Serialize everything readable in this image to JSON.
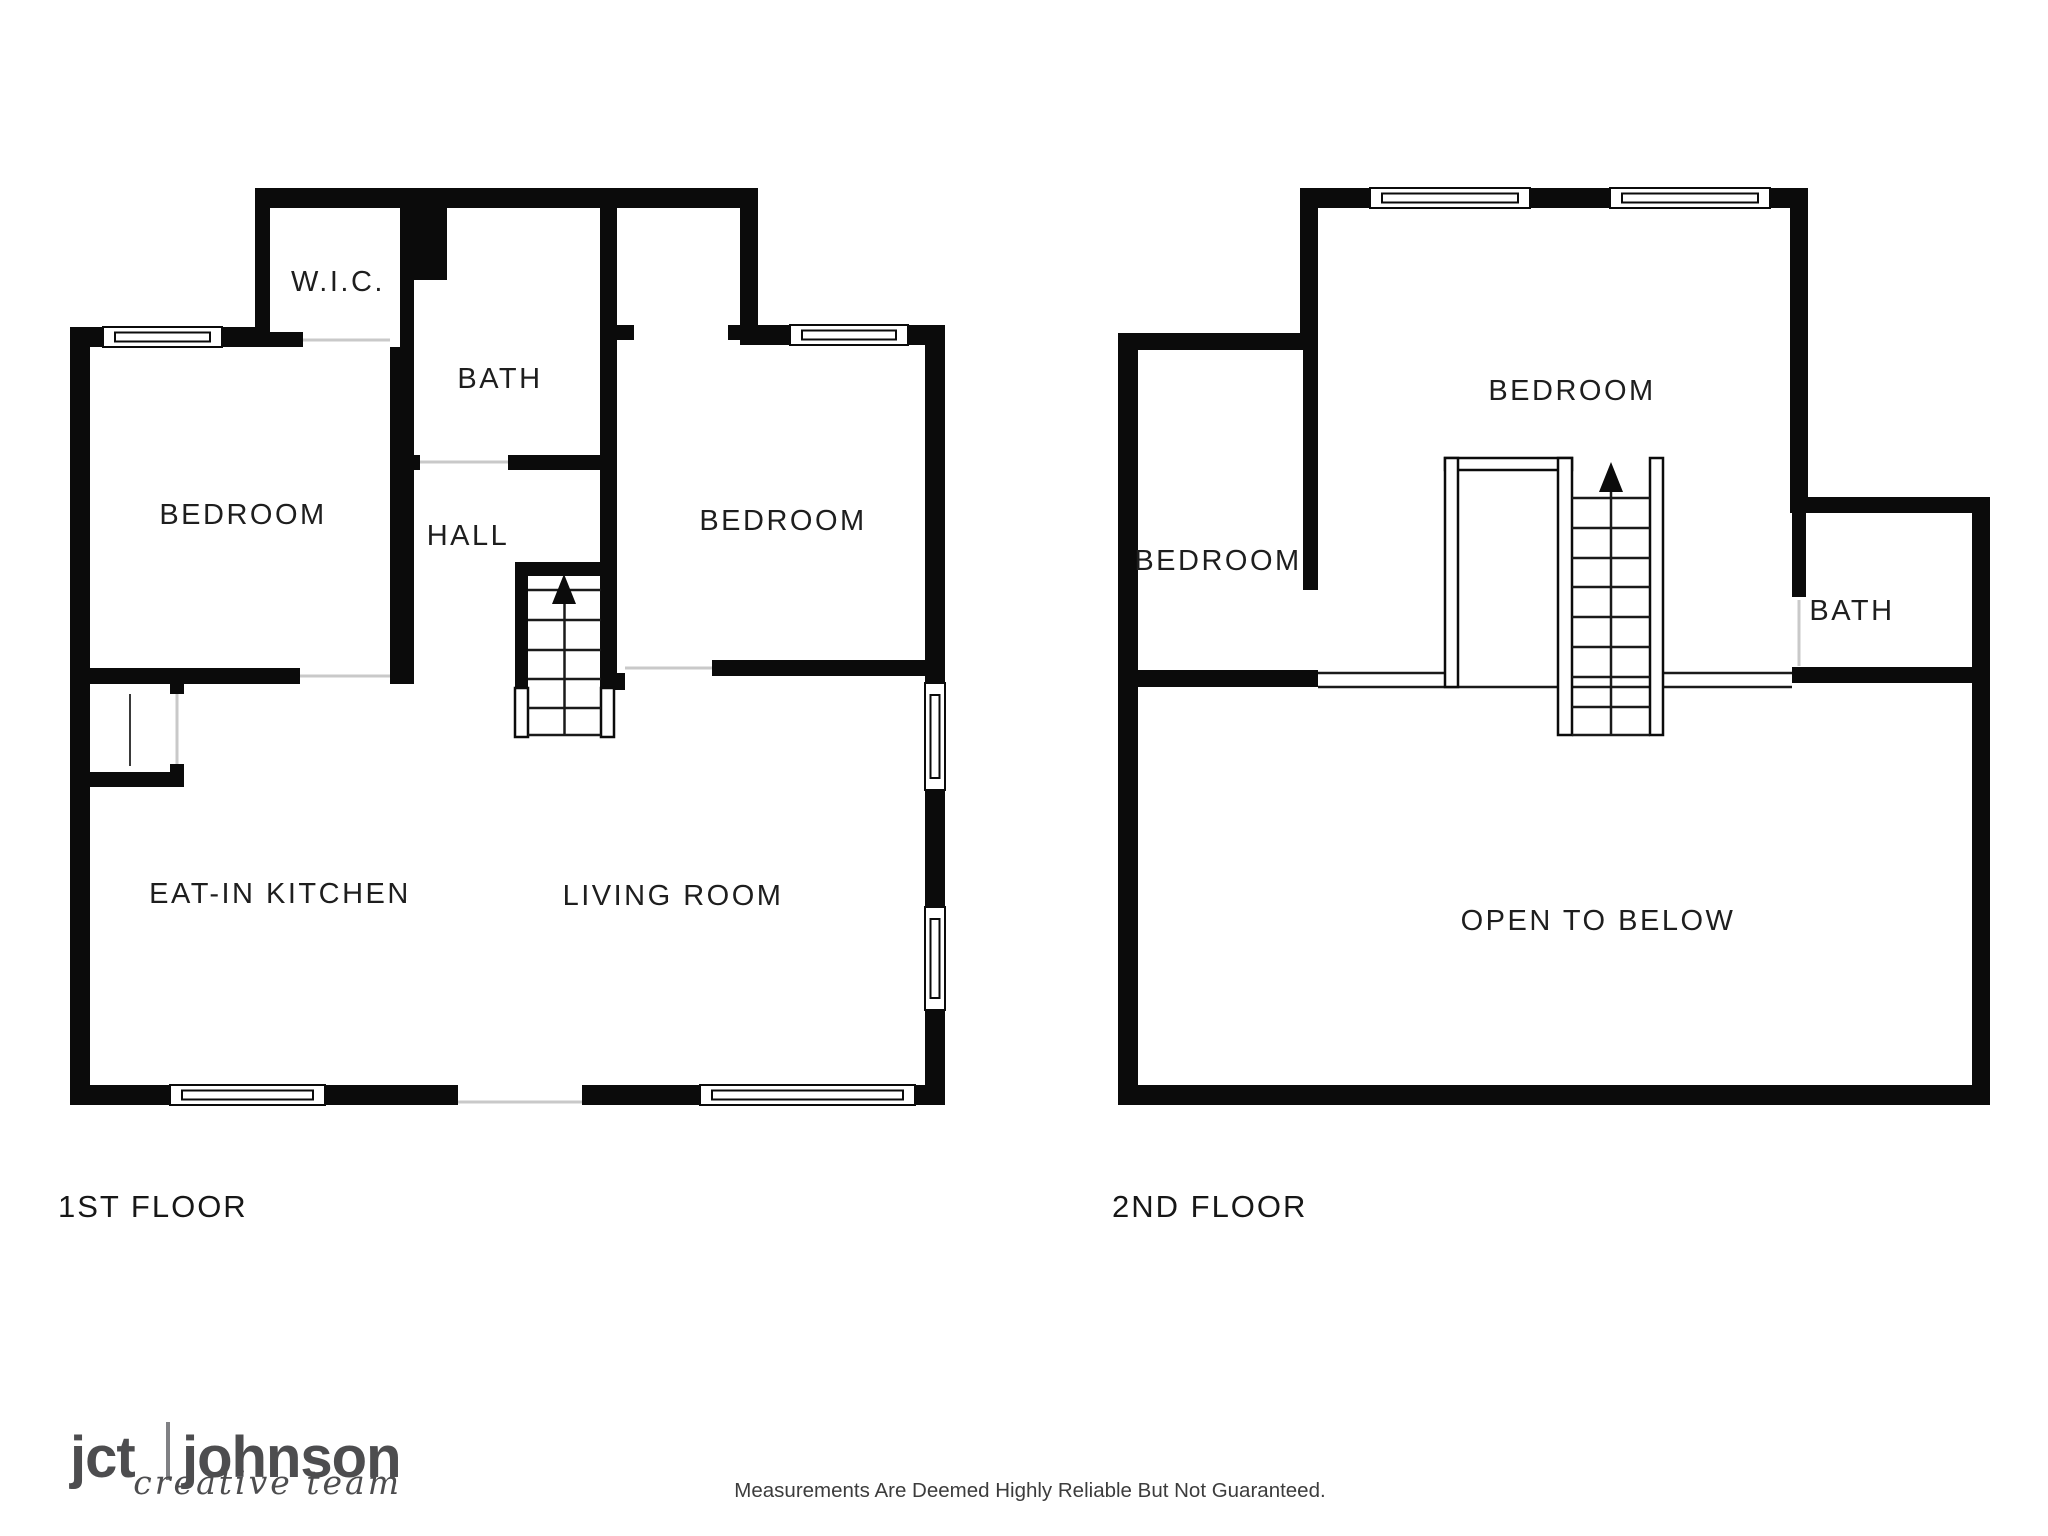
{
  "document": {
    "type": "real-estate floor plan, black and white",
    "background": "#ffffff"
  },
  "floor1": {
    "label": "1ST FLOOR",
    "rooms": {
      "wic": "W.I.C.",
      "bath": "BATH",
      "hall": "HALL",
      "bedroom_left": "BEDROOM",
      "bedroom_right": "BEDROOM",
      "kitchen": "EAT-IN KITCHEN",
      "living": "LIVING ROOM"
    }
  },
  "floor2": {
    "label": "2ND FLOOR",
    "rooms": {
      "bedroom_top": "BEDROOM",
      "bedroom_left": "BEDROOM",
      "bath": "BATH",
      "open_to_below": "OPEN TO BELOW"
    }
  },
  "footer": {
    "logo": {
      "part1": "jct",
      "part2": "johnson",
      "tagline": "creative team"
    },
    "disclaimer": "Measurements Are Deemed Highly Reliable But Not Guaranteed."
  },
  "colors": {
    "wall": "#0b0b0b",
    "label_text": "#1e1e1e",
    "logo_gray": "#4d4d4f",
    "threshold_gray": "#c9c9c9"
  },
  "icons": {
    "stairs_direction": "up-arrow"
  }
}
